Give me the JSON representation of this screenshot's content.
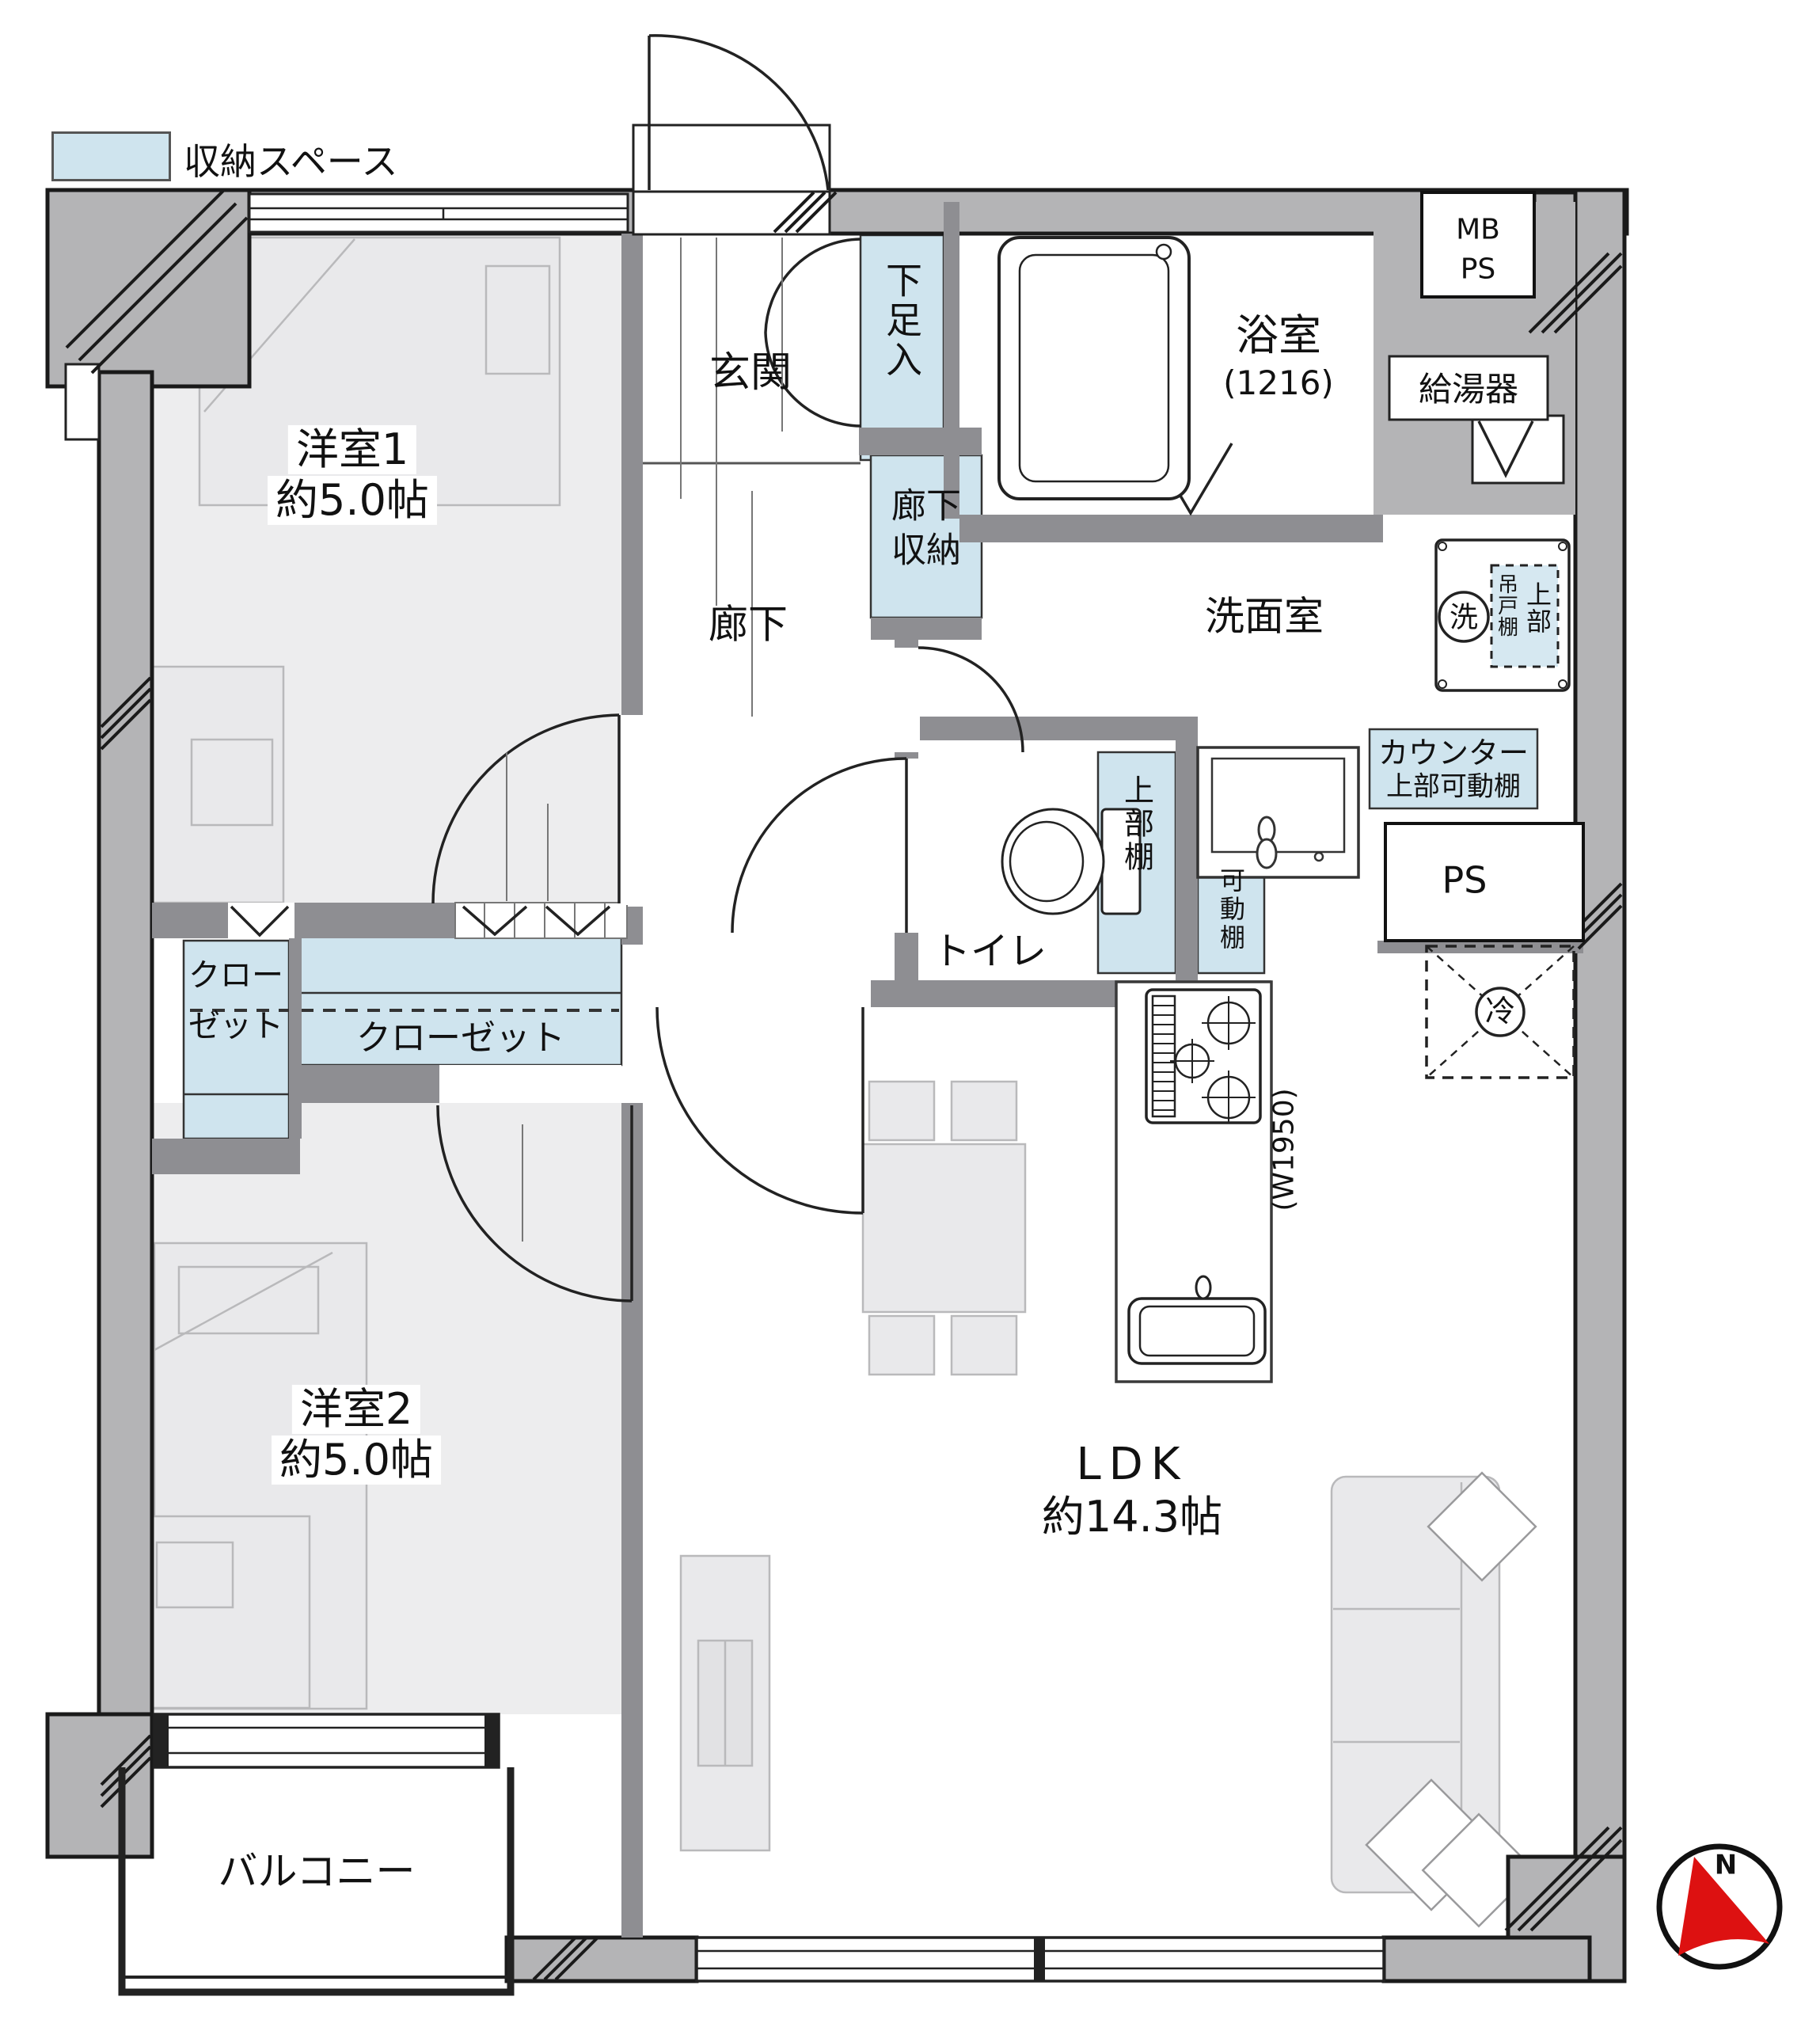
{
  "legend": {
    "label": "収納スペース"
  },
  "rooms": {
    "bedroom1": {
      "name": "洋室1",
      "area": "約5.0帖"
    },
    "bedroom2": {
      "name": "洋室2",
      "area": "約5.0帖"
    },
    "ldk": {
      "name": "LDK",
      "area": "約14.3帖"
    },
    "entrance": {
      "name": "玄関"
    },
    "corridor": {
      "name": "廊下"
    },
    "bathroom": {
      "name": "浴室",
      "size": "(1216)"
    },
    "washroom": {
      "name": "洗面室"
    },
    "toilet": {
      "name": "トイレ"
    },
    "balcony": {
      "name": "バルコニー"
    }
  },
  "storage": {
    "shoe_cabinet": "下足入",
    "hall_storage": {
      "line1": "廊下",
      "line2": "収納"
    },
    "closet_small": {
      "line1": "クロー",
      "line2": "ゼット"
    },
    "closet_large": "クローゼット",
    "toilet_upper_shelf": "上部棚",
    "movable_shelf": "可動棚",
    "counter_shelf": {
      "line1": "カウンター",
      "line2": "上部可動棚"
    },
    "hanging_cabinet": {
      "line1": "吊戸棚",
      "line2": "上部"
    }
  },
  "fixtures": {
    "meter_box": {
      "line1": "MB",
      "line2": "PS"
    },
    "water_heater": "給湯器",
    "pipe_shaft": "PS",
    "washing_machine": "洗",
    "refrigerator": "冷",
    "kitchen_counter_width": "(W1950)"
  },
  "compass": {
    "north": "N"
  },
  "colors": {
    "storage_fill": "#cfe4ee",
    "wall_fill": "#b4b4b6",
    "partition_fill": "#8e8e92",
    "compass_arrow": "#dd1111"
  }
}
